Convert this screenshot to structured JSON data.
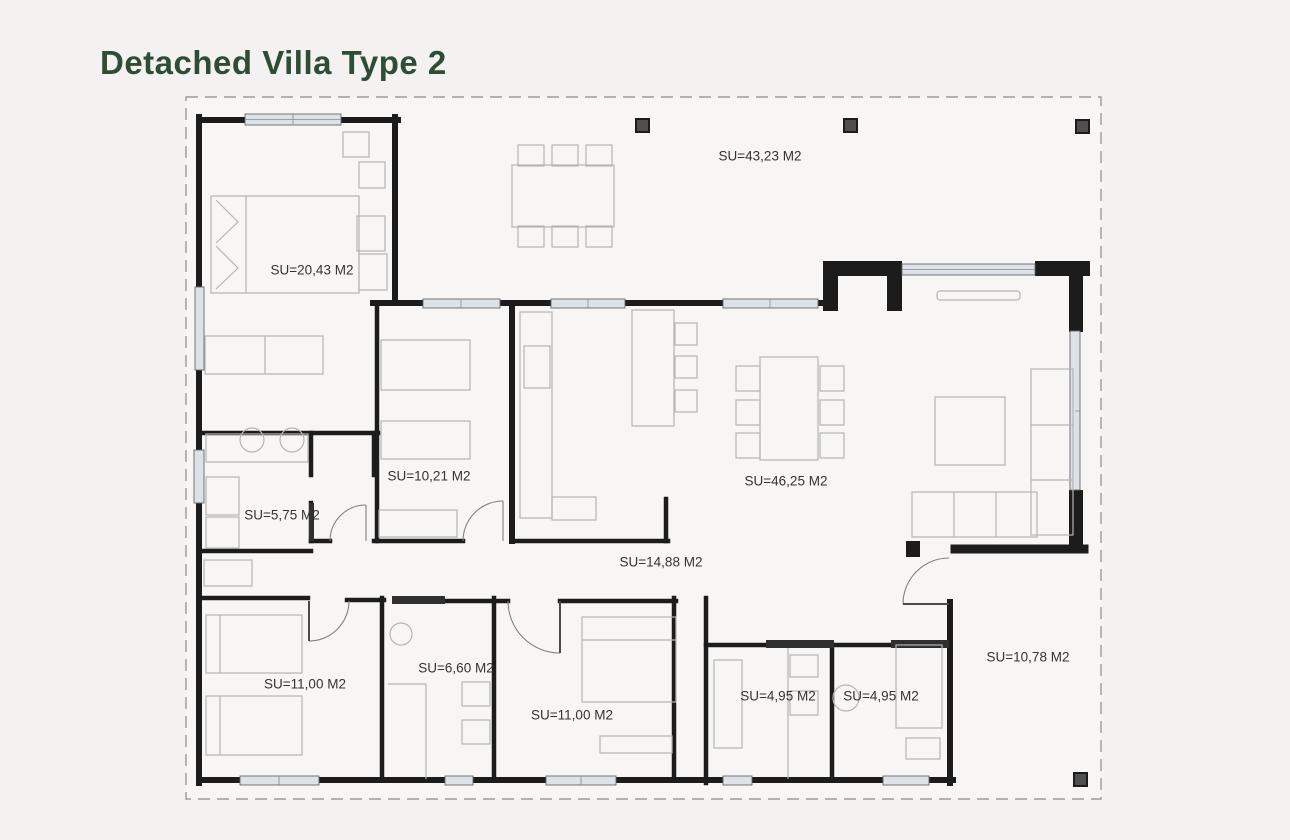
{
  "title": "Detached Villa Type 2",
  "rooms": [
    {
      "name": "top-terrace",
      "label": "SU=43,23 M2"
    },
    {
      "name": "master-bedroom",
      "label": "SU=20,43 M2"
    },
    {
      "name": "bedroom-2",
      "label": "SU=10,21 M2"
    },
    {
      "name": "living-dining-room",
      "label": "SU=46,25 M2"
    },
    {
      "name": "bathroom-1",
      "label": "SU=5,75 M2"
    },
    {
      "name": "kitchen",
      "label": "SU=14,88 M2"
    },
    {
      "name": "bedroom-3",
      "label": "SU=11,00 M2"
    },
    {
      "name": "bathroom-2",
      "label": "SU=6,60 M2"
    },
    {
      "name": "bedroom-4",
      "label": "SU=11,00 M2"
    },
    {
      "name": "bathroom-3",
      "label": "SU=4,95 M2"
    },
    {
      "name": "bathroom-4",
      "label": "SU=4,95 M2"
    },
    {
      "name": "side-terrace",
      "label": "SU=10,78 M2"
    }
  ],
  "colors": {
    "title": "#2f4d35",
    "walls": "#1c1c1c",
    "window_fill": "#dde2e8",
    "furniture": "#b5b5b5",
    "label_text": "#333333",
    "plot_boundary": "#9b9b9b",
    "background": "#f3f2f0",
    "column": "#4f4f4f"
  }
}
